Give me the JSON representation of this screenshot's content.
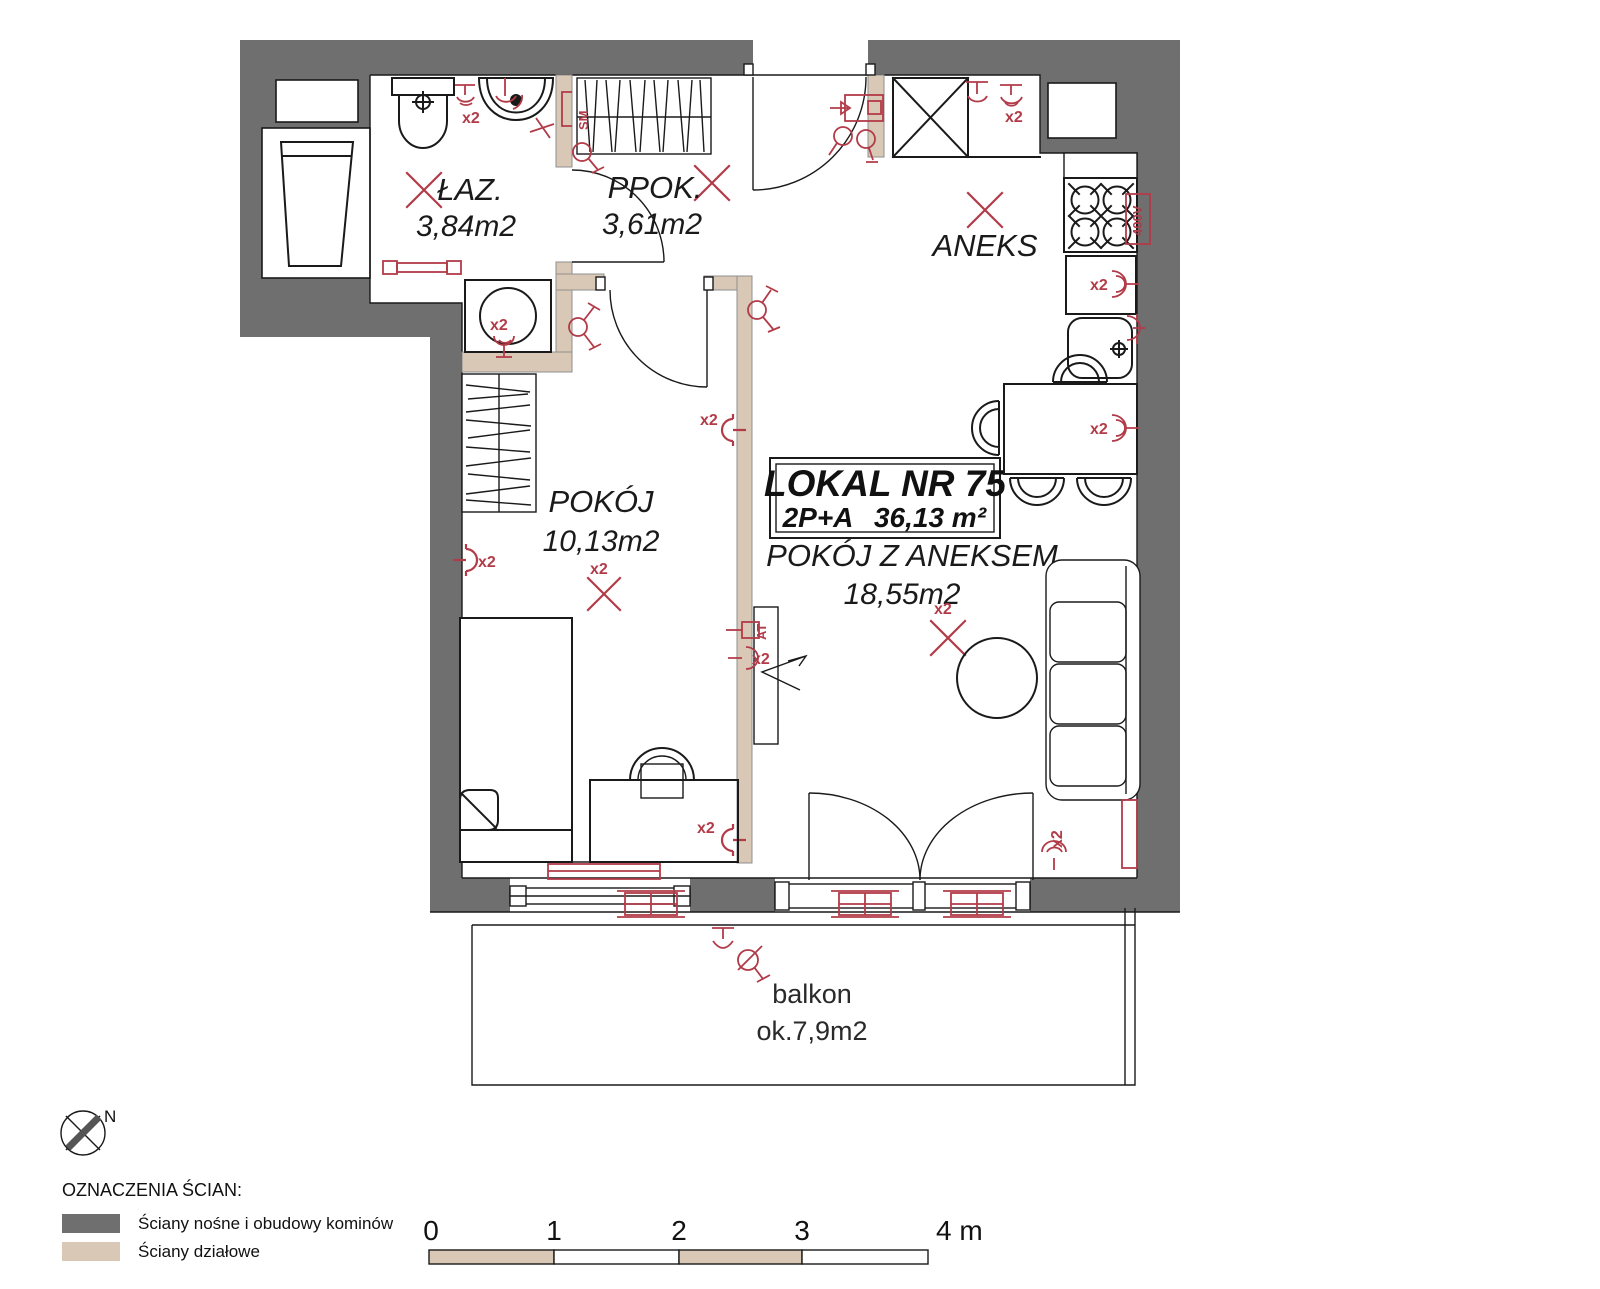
{
  "unit": {
    "title": "LOKAL NR 75",
    "layout": "2P+A",
    "area": "36,13 m²"
  },
  "rooms": {
    "laz": {
      "name": "ŁAZ.",
      "area": "3,84m2"
    },
    "ppok": {
      "name": "PPOK.",
      "area": "3,61m2"
    },
    "aneks": {
      "name": "ANEKS"
    },
    "pokoj": {
      "name": "POKÓJ",
      "area": "10,13m2"
    },
    "salon": {
      "name": "POKÓJ Z ANEKSEM",
      "area": "18,55m2"
    },
    "balkon": {
      "name": "balkon",
      "area": "ok.7,9m2"
    }
  },
  "annotations": {
    "x2": "x2",
    "v400": "400V",
    "at": "AT",
    "sm": "SM",
    "north": "N"
  },
  "legend": {
    "heading": "OZNACZENIA ŚCIAN:",
    "items": [
      {
        "label": "Ściany nośne i obudowy kominów",
        "color": "#6f6f6f"
      },
      {
        "label": "Ściany działowe",
        "color": "#d9c8b5"
      }
    ]
  },
  "scalebar": {
    "ticks": [
      "0",
      "1",
      "2",
      "3",
      "4 m"
    ]
  },
  "colors": {
    "wall": "#6f6f6f",
    "partition": "#d9c8b5",
    "accent": "#b23b48",
    "line": "#1a1a1a"
  }
}
